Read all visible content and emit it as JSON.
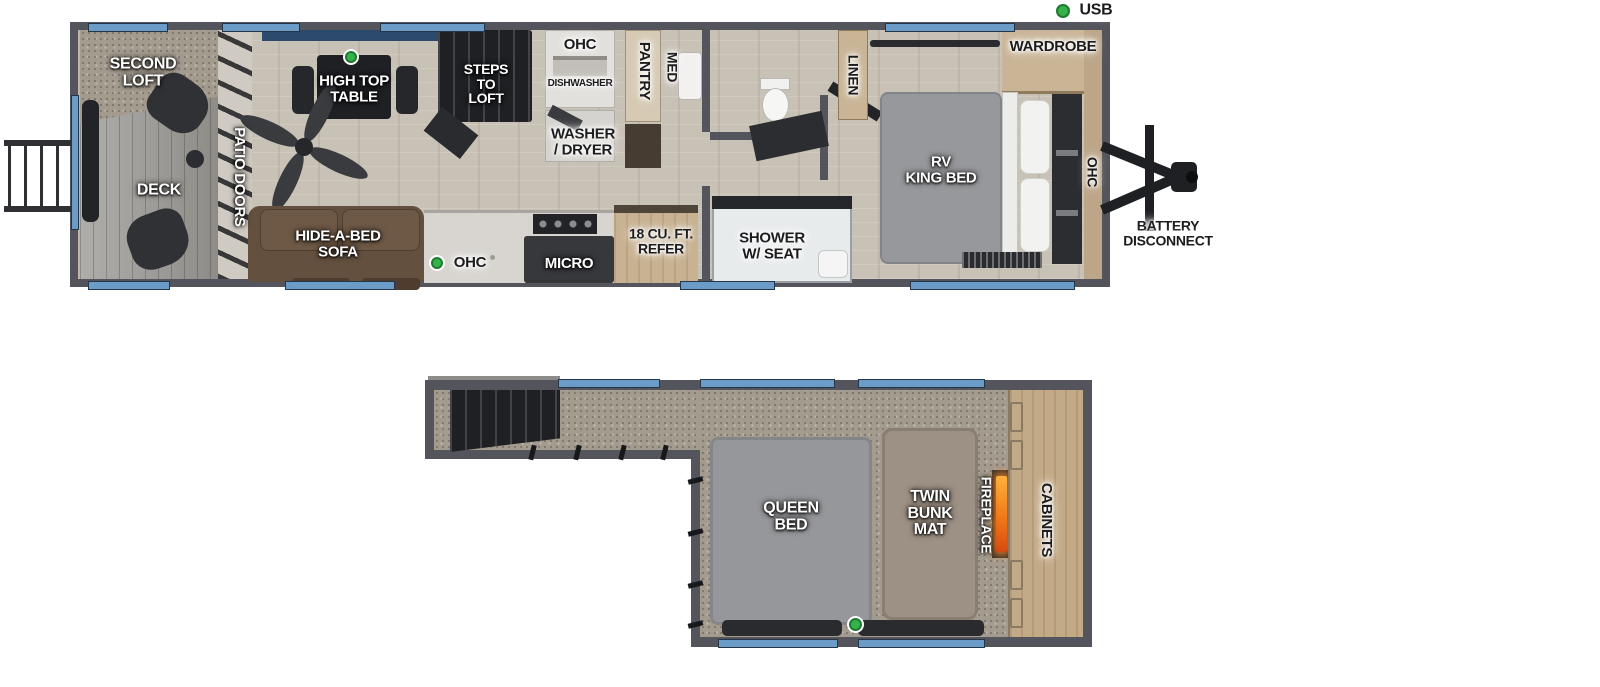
{
  "legend": {
    "usb": "USB"
  },
  "colors": {
    "usb_green": "#35b24a",
    "window_blue": "#6b9cc8",
    "wall_gray": "#54555c",
    "fire_orange": "#f07818"
  },
  "main_floor": {
    "exterior": {
      "battery_disconnect": "BATTERY\nDISCONNECT"
    },
    "deck_area": {
      "second_loft": "SECOND\nLOFT",
      "deck": "DECK",
      "patio_doors": "PATIO DOORS"
    },
    "living": {
      "high_top_table": "HIGH TOP\nTABLE",
      "steps_to_loft": "STEPS\nTO\nLOFT",
      "hide_a_bed_sofa": "HIDE-A-BED\nSOFA"
    },
    "kitchen": {
      "ohc_top": "OHC",
      "dishwasher": "DISHWASHER",
      "pantry": "PANTRY",
      "med": "MED",
      "washer_dryer": "WASHER\n/ DRYER",
      "ohc_bottom": "OHC",
      "micro": "MICRO",
      "refer": "18 CU. FT.\nREFER"
    },
    "bath": {
      "shower": "SHOWER\nW/ SEAT",
      "linen": "LINEN"
    },
    "bedroom": {
      "wardrobe": "WARDROBE",
      "rv_king_bed": "RV\nKING BED",
      "ohc": "OHC"
    }
  },
  "loft": {
    "queen_bed": "QUEEN\nBED",
    "twin_bunk_mat": "TWIN\nBUNK\nMAT",
    "fireplace": "FIREPLACE",
    "cabinets": "CABINETS"
  }
}
